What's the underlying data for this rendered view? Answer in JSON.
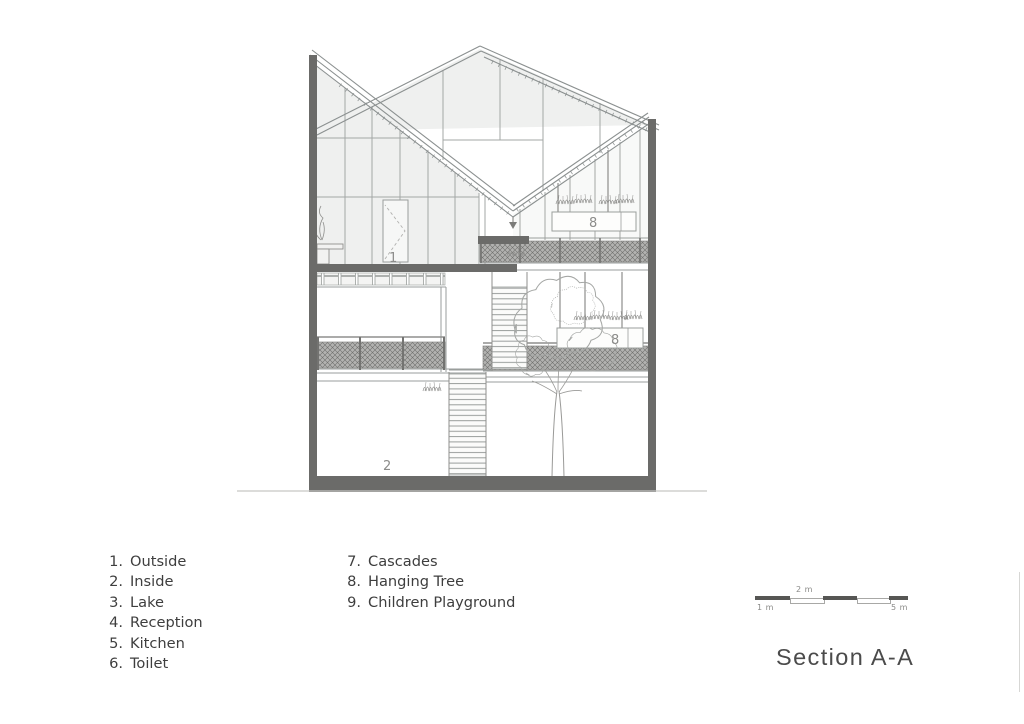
{
  "title": "Section A-A",
  "legend": {
    "items": [
      {
        "num": "1.",
        "label": "Outside"
      },
      {
        "num": "2.",
        "label": "Inside"
      },
      {
        "num": "3.",
        "label": "Lake"
      },
      {
        "num": "4.",
        "label": "Reception"
      },
      {
        "num": "5.",
        "label": "Kitchen"
      },
      {
        "num": "6.",
        "label": "Toilet"
      },
      {
        "num": "7.",
        "label": "Cascades"
      },
      {
        "num": "8.",
        "label": "Hanging Tree"
      },
      {
        "num": "9.",
        "label": "Children Playground"
      }
    ]
  },
  "scale_bar": {
    "label_1": "1 m",
    "label_2": "2 m",
    "label_5": "5 m"
  },
  "section_labels": {
    "door": "1",
    "lower_room": "2",
    "upper_planter": "8",
    "lower_planter": "8"
  },
  "colors": {
    "cut_dark": "#6b6b69",
    "line_gray": "#9a9e9c",
    "glass": "#eff0ef",
    "legend_text": "#3e3e3e",
    "label_gray": "#8c8c8a"
  }
}
